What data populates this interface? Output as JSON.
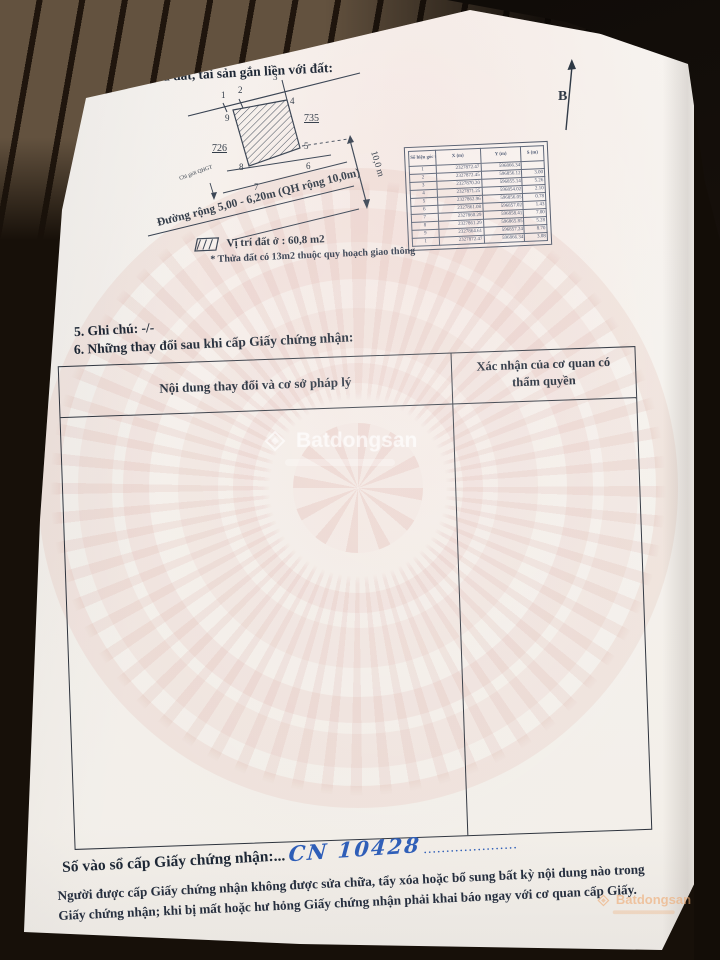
{
  "sections": {
    "s4_title": "4: Sơ đồ thửa đất, tài sản gắn liền với đất:",
    "s5_line": "5. Ghi chú: -/-",
    "s6_title": "6. Những thay đổi sau khi cấp Giấy chứng nhận:"
  },
  "diagram": {
    "north_label": "B",
    "adjacent_parcel_left": "726",
    "adjacent_parcel_right": "735",
    "vertices": [
      "1",
      "2",
      "3",
      "4",
      "5",
      "6",
      "7",
      "8",
      "9"
    ],
    "red_line_label": "Chỉ giới QHGT",
    "road_label": "Đường rộng 5,00 - 6,20m (QH rộng 10,0m)",
    "width_dimension": "10,0 m",
    "legend_area": "Vị trí đất ở : 60,8 m2",
    "legend_note": "* Thửa đất có 13m2 thuộc quy hoạch giao thông"
  },
  "coordinate_table": {
    "headers": [
      "Số hiệu góc thửa",
      "X (m)",
      "Y (m)",
      "S (m)"
    ],
    "rows": [
      [
        "1",
        "2327872.47",
        "596866.34",
        ""
      ],
      [
        "2",
        "2327872.45",
        "596856.12",
        "3.00"
      ],
      [
        "3",
        "2327870.20",
        "596855.14",
        "5.26"
      ],
      [
        "4",
        "2327871.25",
        "596854.02",
        "2.10"
      ],
      [
        "5",
        "2327862.96",
        "596856.05",
        "0.78"
      ],
      [
        "6",
        "2327861.08",
        "596857.02",
        "1.43"
      ],
      [
        "7",
        "2327860.29",
        "596858.41",
        "7.00"
      ],
      [
        "8",
        "2327861.29",
        "596865.85",
        "5.28"
      ],
      [
        "9",
        "2327864.61",
        "596857.24",
        "8.70"
      ],
      [
        "1",
        "2327872.47",
        "596866.34",
        "3.08"
      ]
    ]
  },
  "changes_table": {
    "col_content_header": "Nội dung thay đổi và cơ sở pháp lý",
    "col_confirm_header": "Xác nhận của cơ quan có thẩm quyền"
  },
  "footer": {
    "registry_label": "Số vào sổ cấp Giấy chứng nhận:...",
    "registry_value": "CN 10428",
    "trailing_dots": ".....................",
    "warning": "Người được cấp Giấy chứng nhận không được sửa chữa, tẩy xóa hoặc bổ sung bất kỳ nội dung nào trong Giấy chứng nhận; khi bị mất hoặc hư hỏng Giấy chứng nhận phải khai báo ngay với cơ quan cấp Giấy."
  },
  "watermark": {
    "brand": "Batdongsan"
  }
}
